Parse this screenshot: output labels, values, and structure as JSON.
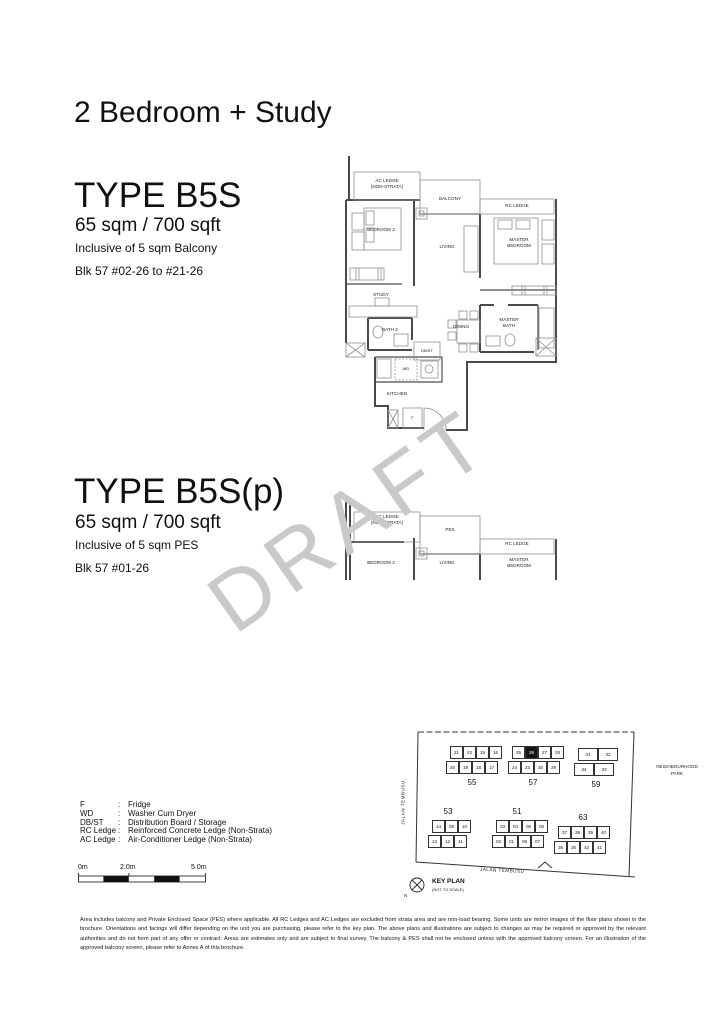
{
  "page": {
    "title": "2 Bedroom + Study"
  },
  "types": [
    {
      "name": "TYPE B5S",
      "area": "65 sqm / 700 sqft",
      "inclusive": "Inclusive of 5 sqm Balcony",
      "blocks": "Blk 57 #02-26 to #21-26"
    },
    {
      "name": "TYPE B5S(p)",
      "area": "65 sqm / 700 sqft",
      "inclusive": "Inclusive of 5 sqm PES",
      "blocks": "Blk 57 #01-26"
    }
  ],
  "watermark": "DRAFT",
  "plan1": {
    "labels": {
      "ac_ledge": "AC LEDGE\n(NON-STRATA)",
      "balcony": "BALCONY",
      "rc_ledge": "RC LEDGE",
      "bedroom2": "BEDROOM 2",
      "living": "LIVING",
      "master_bedroom": "MASTER\nBEDROOM",
      "study": "STUDY",
      "bath2": "BATH 2",
      "dbst": "DB/ST",
      "wd": "WD",
      "kitchen": "KITCHEN",
      "fridge": "F",
      "dining": "DINING",
      "master_bath": "MASTER\nBATH"
    }
  },
  "plan2": {
    "labels": {
      "ac_ledge": "AC LEDGE\n(NON-STRATA)",
      "pes": "PES",
      "rc_ledge": "RC LEDGE",
      "bedroom2": "BEDROOM 2",
      "living": "LIVING",
      "master_bedroom": "MASTER\nBEDROOM"
    }
  },
  "keyplan": {
    "title": "KEY PLAN",
    "subtitle": "(NOT TO SCALE)",
    "north": "N",
    "road_left": "JALAN TEMBUSU",
    "road_bottom": "JALAN TEMBUSU",
    "park": "NEIGHBOURHOOD\nPARK",
    "highlight_unit": "26",
    "blocks": [
      {
        "number": "55",
        "rows": [
          [
            "21",
            "22",
            "15",
            "16"
          ],
          [
            "20",
            "19",
            "18",
            "17"
          ]
        ]
      },
      {
        "number": "57",
        "rows": [
          [
            "25",
            "26",
            "27",
            "28"
          ],
          [
            "24",
            "23",
            "30",
            "29"
          ]
        ]
      },
      {
        "number": "59",
        "rows": [
          [
            "31",
            "32"
          ],
          [
            "34",
            "33"
          ]
        ]
      },
      {
        "number": "53",
        "rows": [
          [
            "14",
            "09",
            "10"
          ],
          [
            "13",
            "12",
            "11"
          ]
        ]
      },
      {
        "number": "51",
        "rows": [
          [
            "03",
            "04",
            "05",
            "06"
          ],
          [
            "02",
            "01",
            "08",
            "07"
          ]
        ]
      },
      {
        "number": "63",
        "rows": [
          [
            "37",
            "38",
            "39",
            "40"
          ],
          [
            "36",
            "35",
            "42",
            "41"
          ]
        ]
      }
    ]
  },
  "legend": {
    "items": [
      {
        "term": "F",
        "desc": "Fridge"
      },
      {
        "term": "WD",
        "desc": "Washer Cum Dryer"
      },
      {
        "term": "DB/ST",
        "desc": "Distribution Board / Storage"
      },
      {
        "term": "RC Ledge",
        "desc": "Reinforced Concrete Ledge (Non-Strata)"
      },
      {
        "term": "AC Ledge",
        "desc": "Air-Conditioner Ledge (Non-Strata)"
      }
    ]
  },
  "scalebar": {
    "labels": [
      "0m",
      "2.0m",
      "5.0m"
    ]
  },
  "disclaimer": "Area includes balcony and Private Enclosed Space (PES) where applicable. All RC Ledges and AC Ledges are excluded from strata area and are non-load bearing. Some units are mirror images of the floor plans shown in the brochure. Orientations and facings will differ depending on the unit you are purchasing, please refer to the key plan. The above plans and illustrations are subject to changes as may be required or approved by the relevant authorities and do not form part of any offer or contract. Areas are estimates only and are subject to final survey. The balcony & PES shall not be enclosed unless with the approved balcony screen. For an illustration of the approved balcony screen, please refer to Annex A of this brochure.",
  "colors": {
    "watermark": "#c9c9c9",
    "highlight_unit": "#161616",
    "walls": "#4a4a4a"
  }
}
